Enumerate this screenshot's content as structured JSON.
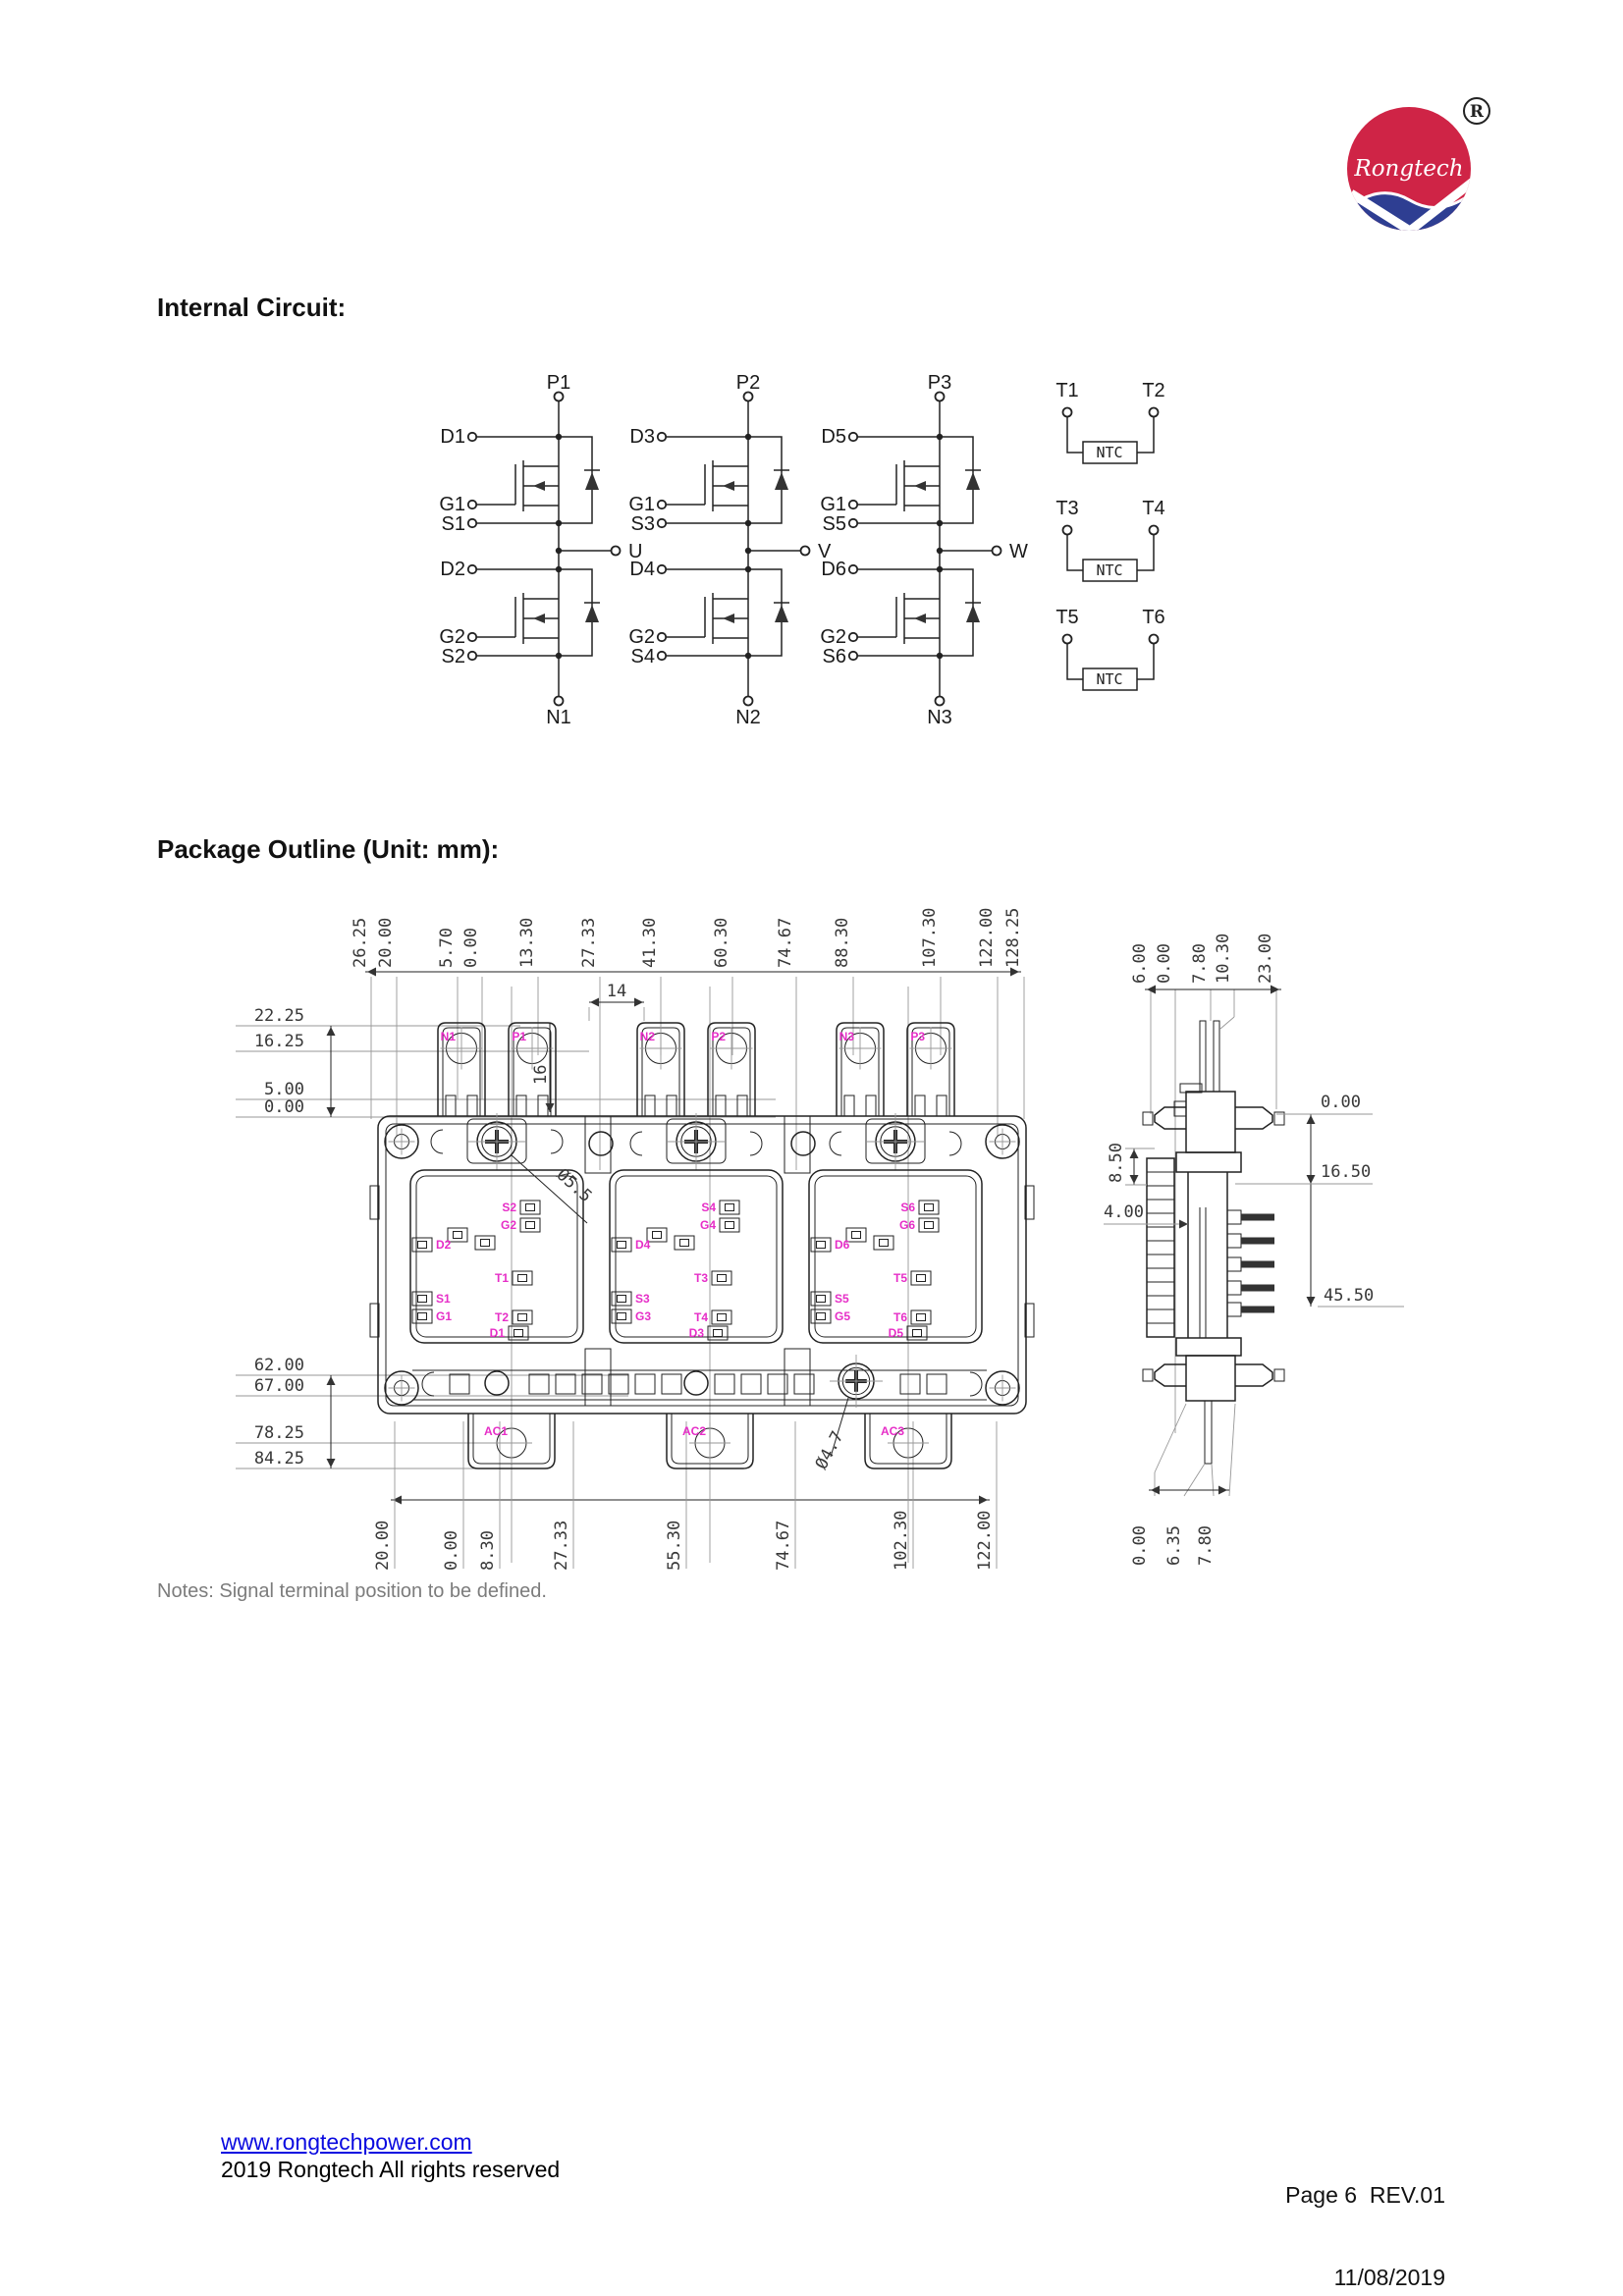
{
  "logo": {
    "brand": "Rongtech",
    "registered_mark": "R"
  },
  "headings": {
    "internal_circuit": "Internal Circuit:",
    "package_outline": "Package Outline (Unit: mm):",
    "notes": "Notes: Signal terminal position to be defined."
  },
  "circuit": {
    "phases": [
      {
        "p": "P1",
        "n": "N1",
        "out": "U",
        "d_top": "D1",
        "g_top": "G1",
        "s_top": "S1",
        "d_bot": "D2",
        "g_bot": "G2",
        "s_bot": "S2"
      },
      {
        "p": "P2",
        "n": "N2",
        "out": "V",
        "d_top": "D3",
        "g_top": "G1",
        "s_top": "S3",
        "d_bot": "D4",
        "g_bot": "G2",
        "s_bot": "S4"
      },
      {
        "p": "P3",
        "n": "N3",
        "out": "W",
        "d_top": "D5",
        "g_top": "G1",
        "s_top": "S5",
        "d_bot": "D6",
        "g_bot": "G2",
        "s_bot": "S6"
      }
    ],
    "ntc": {
      "label": "NTC",
      "pairs": [
        [
          "T1",
          "T2"
        ],
        [
          "T3",
          "T4"
        ],
        [
          "T5",
          "T6"
        ]
      ]
    }
  },
  "package": {
    "top_dims": [
      "26.25",
      "20.00",
      "5.70",
      "0.00",
      "13.30",
      "27.33",
      "41.30",
      "60.30",
      "74.67",
      "88.30",
      "107.30",
      "122.00",
      "128.25"
    ],
    "left_dims_upper": [
      "22.25",
      "16.25",
      "5.00",
      "0.00"
    ],
    "left_dims_lower": [
      "62.00",
      "67.00",
      "78.25",
      "84.25"
    ],
    "bottom_dims": [
      "20.00",
      "0.00",
      "8.30",
      "27.33",
      "55.30",
      "74.67",
      "102.30",
      "122.00"
    ],
    "tab_labels": [
      "N1",
      "P1",
      "N2",
      "P2",
      "N3",
      "P3"
    ],
    "ac_labels": [
      "AC1",
      "AC2",
      "AC3"
    ],
    "section_labels": [
      [
        "S2",
        "G2",
        "D2",
        "T1",
        "S1",
        "G1",
        "T2",
        "D1"
      ],
      [
        "S4",
        "G4",
        "D4",
        "T3",
        "S3",
        "G3",
        "T4",
        "D3"
      ],
      [
        "S6",
        "G6",
        "D6",
        "T5",
        "S5",
        "G5",
        "T6",
        "D5"
      ]
    ],
    "inline_dims": {
      "tab_width": "14",
      "tab_height": "16",
      "mount_hole": "Ø5.5",
      "pin_hole": "Ø4.7"
    },
    "side": {
      "top_dims": [
        "6.00",
        "0.00",
        "7.80",
        "10.30",
        "23.00"
      ],
      "right_dims": [
        "0.00",
        "16.50",
        "45.50"
      ],
      "left_dims": [
        "8.50",
        "4.00"
      ],
      "bottom_dims": [
        "0.00",
        "6.35",
        "7.80"
      ]
    }
  },
  "footer": {
    "website": "www.rongtechpower.com",
    "copyright": "2019 Rongtech All rights reserved",
    "page": "Page 6  REV.01",
    "date": "11/08/2019"
  }
}
